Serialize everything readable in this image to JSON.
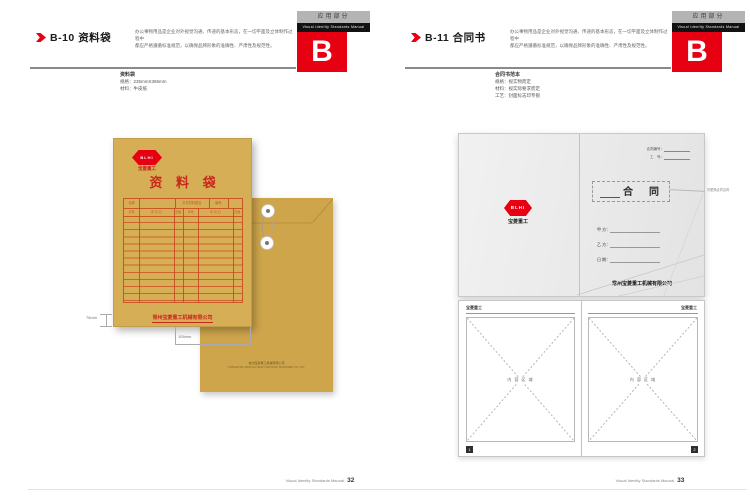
{
  "colors": {
    "accent": "#e60012",
    "kraft_front": "#d6ae55",
    "kraft_back": "#cfa54b",
    "table_line": "#c8481c"
  },
  "shared": {
    "tab_label": "应用部分",
    "tab_manual": "Visual Identity Standards Manual",
    "tab_letter": "B",
    "description_line1": "办公事物用品是企业对外视觉沟通、传递的基本形态，在一切平面及立体制作过程中",
    "description_line2": "都应严格遵循标准规范，以确保品牌形象的准确性、严肃性及规范性。",
    "footer_text": "Visual Identity Standards Manual",
    "logo_text": "BLHI",
    "logo_caption": "宝菱重工",
    "company": "常州宝菱重工机械有限公司"
  },
  "left_page": {
    "code": "B-10",
    "title": "资料袋",
    "page_number": "32",
    "specs_title": "资料袋",
    "spec1": "规格：235mmX365mm",
    "spec2": "材料：牛皮纸",
    "envelope": {
      "title": "资 料 袋",
      "table_h1": "名称",
      "table_h2": "文件材料题名",
      "table_h3": "编号",
      "table_s1": "序号",
      "table_s2": "年 月 日",
      "table_s3": "页数",
      "back_print_cn": "常州宝菱重工机械有限公司",
      "back_print_en": "CHANGZHOU BAOLING HEAVY INDUSTRY MACHINERY CO.,LTD."
    },
    "dim_h": "78mm",
    "dim_w": "105mm"
  },
  "right_page": {
    "code": "B-11",
    "title": "合同书",
    "page_number": "33",
    "specs_title": "合同书范本",
    "spec1": "规格：视实物而定",
    "spec2": "材料：视实际要求而定",
    "spec3": "工艺：封面标志印专银",
    "contract": {
      "no_label": "合同编号：",
      "code_label": "工　号：",
      "title": "合　同",
      "annotation": "可更换合同名称",
      "field1": "甲 方：",
      "field2": "乙 方：",
      "field3": "日 期：",
      "inner_header": "宝菱重工",
      "placeholder": "内 容 区 域",
      "page_marker_left": "1",
      "page_marker_right": "2"
    }
  }
}
